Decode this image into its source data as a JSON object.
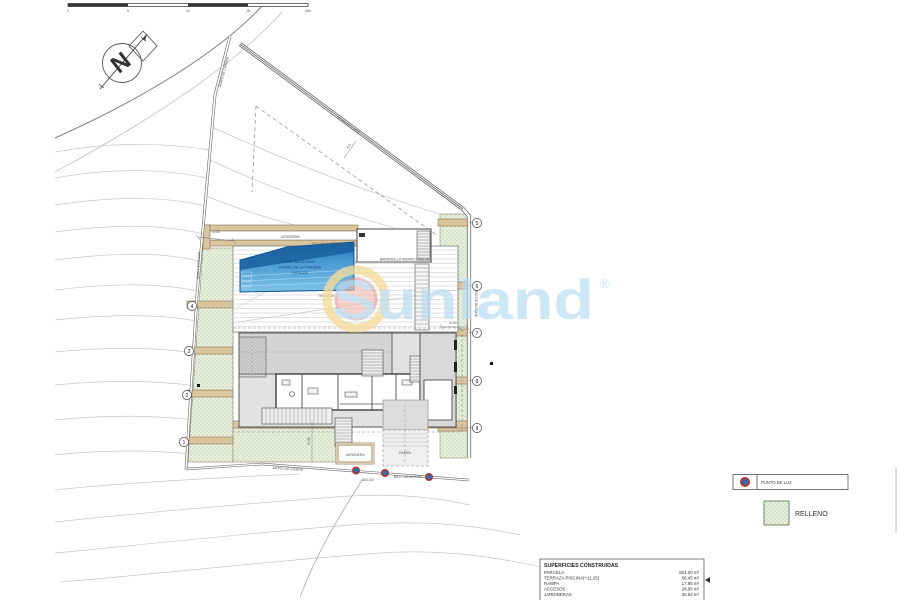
{
  "scale": {
    "labels": [
      "0",
      "5",
      "10",
      "15",
      "20m"
    ]
  },
  "compass": {
    "n": "N"
  },
  "watermark": {
    "text": "Sunland",
    "reg": "®"
  },
  "wall_labels": {
    "carrer": "MURO DE CARRER",
    "linde_top": "MURO DE LINDE",
    "linde_left": "MURO DE LINDE",
    "bloque_right": "MURO DE BLOQUE",
    "cierre": "MURO DE CIERRE",
    "bajo_motor": "BAJO DE MOTOR",
    "baliza": "BALIZA"
  },
  "plan": {
    "jardinera_top": "JARDINERA",
    "jardinera_left": "JARDINERA",
    "jardinera_bottom": "JARDINERA",
    "terraza": "TERRAZA",
    "solarium": "SOLARIUM TECHO",
    "barandilla": "BARANDILLA HIERRO-CRISTAL",
    "rampa": "RAMPA"
  },
  "pool": {
    "l1": "PISCINA 32.00 m²",
    "l2": "A NIVEL DE LA VIVIENDA",
    "l3": "2 FOCOS"
  },
  "dims": {
    "top_left": "4.00",
    "right": "4.00",
    "stairs": "5.00",
    "roof": "4.0"
  },
  "markers": {
    "left": [
      "1",
      "2",
      "3",
      "4"
    ],
    "right": [
      "5",
      "6",
      "7",
      "8",
      "9"
    ]
  },
  "legend": {
    "punto": "PUNTO DE LUZ",
    "relleno": "RELLENO"
  },
  "table": {
    "title": "SUPERFICIES CONSTRUIDAS",
    "rows": [
      {
        "label": "PARCELA",
        "value": "824.00 m²"
      },
      {
        "label": "TERRAZA PISCINA(+11.25)",
        "value": "56.45 m²"
      },
      {
        "label": "RAMPA",
        "value": "17.95 m²"
      },
      {
        "label": "ACCESOS",
        "value": "28.95 m²"
      },
      {
        "label": "JARDINERAS",
        "value": "30.54 m²"
      }
    ]
  },
  "colors": {
    "pool_dark": "#1e6cb0",
    "pool_light": "#7ec2e8",
    "relleno_green": "#e9efdd",
    "relleno_dot": "#9db387",
    "tan_wall": "#d9c69e",
    "tan_border": "#8a6f4d",
    "watermark_blue": "#b7dcf2",
    "sun_yellow": "#f3dc9b",
    "sun_red": "#f2b3ab",
    "light_dot_blue": "#2a6fb8",
    "light_dot_red": "#b03a2e"
  }
}
